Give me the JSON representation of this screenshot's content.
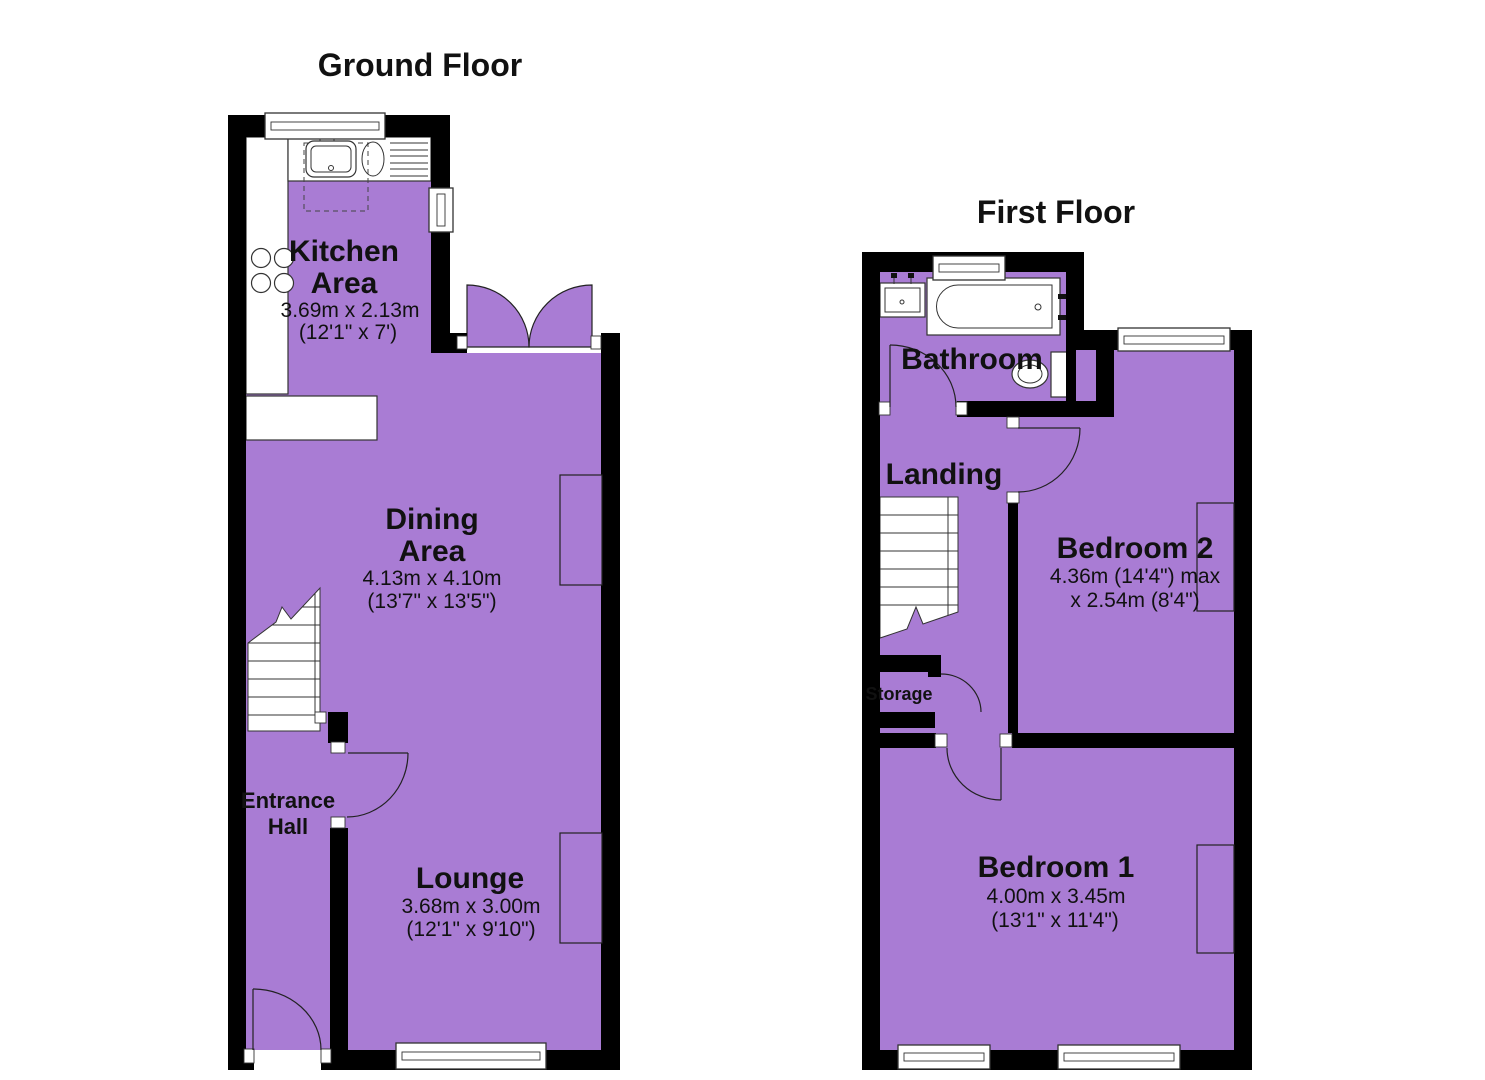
{
  "document": {
    "type": "floorplan"
  },
  "colors": {
    "room_fill": "#A97CD4",
    "wall": "#000000",
    "background": "#FFFFFF",
    "text": "#111111"
  },
  "ground_floor": {
    "title": "Ground Floor",
    "kitchen": {
      "label_line1": "Kitchen",
      "label_line2": "Area",
      "dim_metric": "3.69m x 2.13m",
      "dim_imperial": "(12'1\" x 7')"
    },
    "dining": {
      "label_line1": "Dining",
      "label_line2": "Area",
      "dim_metric": "4.13m x 4.10m",
      "dim_imperial": "(13'7\" x 13'5\")"
    },
    "lounge": {
      "label": "Lounge",
      "dim_metric": "3.68m x 3.00m",
      "dim_imperial": "(12'1\" x 9'10\")"
    },
    "hall": {
      "label_line1": "Entrance",
      "label_line2": "Hall"
    }
  },
  "first_floor": {
    "title": "First Floor",
    "bathroom": {
      "label": "Bathroom"
    },
    "landing": {
      "label": "Landing"
    },
    "storage": {
      "label": "Storage"
    },
    "bedroom2": {
      "label": "Bedroom 2",
      "dim_line1": "4.36m (14'4\") max",
      "dim_line2": "x 2.54m (8'4\")"
    },
    "bedroom1": {
      "label": "Bedroom 1",
      "dim_metric": "4.00m x 3.45m",
      "dim_imperial": "(13'1\" x 11'4\")"
    }
  }
}
